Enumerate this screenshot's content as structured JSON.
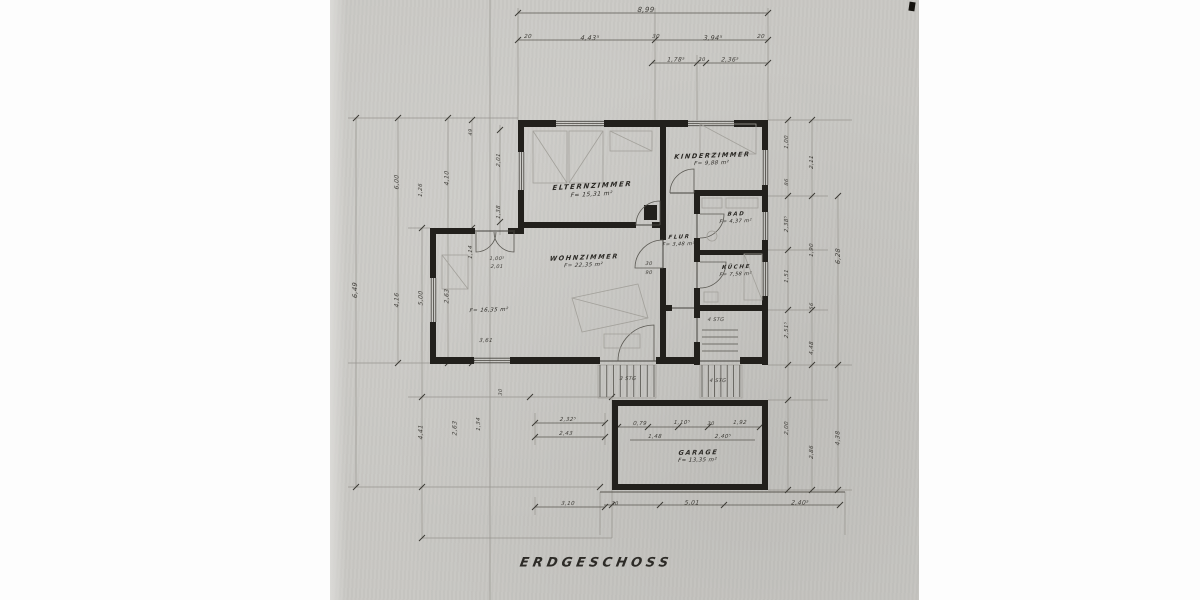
{
  "page": {
    "title": "ERDGESCHOSS"
  },
  "rooms": [
    {
      "id": "elternzimmer",
      "name": "ELTERNZIMMER",
      "area": "F= 15,31 m²",
      "x": 592,
      "y": 190,
      "fs": 7,
      "afs": 6,
      "rot": -3
    },
    {
      "id": "kinderzimmer",
      "name": "KINDERZIMMER",
      "area": "F= 9,88 m²",
      "x": 712,
      "y": 159,
      "fs": 6.5,
      "afs": 5.5,
      "rot": -2
    },
    {
      "id": "bad",
      "name": "BAD",
      "area": "F= 4,37 m²",
      "x": 736,
      "y": 218,
      "fs": 5.5,
      "afs": 5,
      "rot": -2
    },
    {
      "id": "flur",
      "name": "FLUR",
      "area": "F= 3,48 m²",
      "x": 679,
      "y": 241,
      "fs": 5.5,
      "afs": 5,
      "rot": -2
    },
    {
      "id": "kueche",
      "name": "KÜCHE",
      "area": "F= 7,58 m²",
      "x": 736,
      "y": 271,
      "fs": 5.5,
      "afs": 5,
      "rot": -2
    },
    {
      "id": "wohnzimmer",
      "name": "WOHNZIMMER",
      "area": "F= 22,35 m²",
      "x": 584,
      "y": 261,
      "fs": 6.5,
      "afs": 5.5,
      "rot": -2
    },
    {
      "id": "wohnzimmer-erker",
      "name": "",
      "area": "F= 16,35 m²",
      "x": 489,
      "y": 310,
      "fs": 6,
      "afs": 5.5,
      "rot": -2
    },
    {
      "id": "garage",
      "name": "GARAGE",
      "area": "F= 13,35 m²",
      "x": 698,
      "y": 456,
      "fs": 6.5,
      "afs": 5.5,
      "rot": -1
    }
  ],
  "dims": [
    {
      "t": "8,99",
      "x": 646,
      "y": 10,
      "r": 0,
      "fs": 7
    },
    {
      "t": "20",
      "x": 528,
      "y": 37,
      "r": 0,
      "fs": 5.5
    },
    {
      "t": "4,43⁵",
      "x": 590,
      "y": 38,
      "r": 0,
      "fs": 6.5
    },
    {
      "t": "30",
      "x": 656,
      "y": 37,
      "r": 0,
      "fs": 5.5
    },
    {
      "t": "3,94⁵",
      "x": 713,
      "y": 38,
      "r": 0,
      "fs": 6.5
    },
    {
      "t": "20",
      "x": 761,
      "y": 37,
      "r": 0,
      "fs": 5.5
    },
    {
      "t": "1,78⁵",
      "x": 676,
      "y": 60,
      "r": 0,
      "fs": 6
    },
    {
      "t": "30",
      "x": 702,
      "y": 60,
      "r": 0,
      "fs": 5
    },
    {
      "t": "2,36⁵",
      "x": 730,
      "y": 60,
      "r": 0,
      "fs": 6
    },
    {
      "t": "6,49",
      "x": 355,
      "y": 290,
      "r": -90,
      "fs": 6.5
    },
    {
      "t": "6,00",
      "x": 397,
      "y": 182,
      "r": -90,
      "fs": 6
    },
    {
      "t": "4,16",
      "x": 397,
      "y": 300,
      "r": -90,
      "fs": 6
    },
    {
      "t": "1,26",
      "x": 421,
      "y": 190,
      "r": -90,
      "fs": 5.5
    },
    {
      "t": "5,00",
      "x": 421,
      "y": 298,
      "r": -90,
      "fs": 6
    },
    {
      "t": "4,10",
      "x": 447,
      "y": 178,
      "r": -90,
      "fs": 6
    },
    {
      "t": "2,63",
      "x": 447,
      "y": 296,
      "r": -90,
      "fs": 6
    },
    {
      "t": "49",
      "x": 471,
      "y": 132,
      "r": -90,
      "fs": 5
    },
    {
      "t": "1,14",
      "x": 471,
      "y": 252,
      "r": -90,
      "fs": 5.5
    },
    {
      "t": "2,01",
      "x": 499,
      "y": 160,
      "r": -90,
      "fs": 5.5
    },
    {
      "t": "1,38",
      "x": 499,
      "y": 212,
      "r": -90,
      "fs": 5.5
    },
    {
      "t": "1,00⁵",
      "x": 497,
      "y": 259,
      "r": 0,
      "fs": 5
    },
    {
      "t": "2,01",
      "x": 497,
      "y": 267,
      "r": 0,
      "fs": 5
    },
    {
      "t": "30",
      "x": 649,
      "y": 264,
      "r": 0,
      "fs": 5
    },
    {
      "t": "90",
      "x": 649,
      "y": 273,
      "r": 0,
      "fs": 5
    },
    {
      "t": "3,61",
      "x": 486,
      "y": 341,
      "r": 0,
      "fs": 5.5
    },
    {
      "t": "4,41",
      "x": 421,
      "y": 432,
      "r": -90,
      "fs": 6
    },
    {
      "t": "2,63",
      "x": 455,
      "y": 428,
      "r": -90,
      "fs": 6
    },
    {
      "t": "1,34",
      "x": 479,
      "y": 424,
      "r": -90,
      "fs": 5.5
    },
    {
      "t": "30",
      "x": 501,
      "y": 392,
      "r": -90,
      "fs": 5
    },
    {
      "t": "2,32⁵",
      "x": 568,
      "y": 420,
      "r": 0,
      "fs": 5.5
    },
    {
      "t": "2,43",
      "x": 566,
      "y": 434,
      "r": 0,
      "fs": 5.5
    },
    {
      "t": "3,10",
      "x": 568,
      "y": 504,
      "r": 0,
      "fs": 5.5
    },
    {
      "t": "0,79",
      "x": 640,
      "y": 424,
      "r": 0,
      "fs": 5.5
    },
    {
      "t": "1,10⁵",
      "x": 682,
      "y": 423,
      "r": 0,
      "fs": 5.5
    },
    {
      "t": "30",
      "x": 711,
      "y": 424,
      "r": 0,
      "fs": 5
    },
    {
      "t": "1,92",
      "x": 740,
      "y": 423,
      "r": 0,
      "fs": 5.5
    },
    {
      "t": "1,48",
      "x": 655,
      "y": 437,
      "r": 0,
      "fs": 5.5
    },
    {
      "t": "2,40⁵",
      "x": 723,
      "y": 437,
      "r": 0,
      "fs": 5.5
    },
    {
      "t": "30",
      "x": 615,
      "y": 504,
      "r": 0,
      "fs": 5
    },
    {
      "t": "5,01",
      "x": 692,
      "y": 503,
      "r": 0,
      "fs": 6
    },
    {
      "t": "2,40⁵",
      "x": 800,
      "y": 503,
      "r": 0,
      "fs": 6
    },
    {
      "t": "1,00",
      "x": 787,
      "y": 142,
      "r": -90,
      "fs": 5.5
    },
    {
      "t": "86",
      "x": 787,
      "y": 182,
      "r": -90,
      "fs": 5
    },
    {
      "t": "2,38⁵",
      "x": 787,
      "y": 224,
      "r": -90,
      "fs": 5.5
    },
    {
      "t": "1,51",
      "x": 787,
      "y": 276,
      "r": -90,
      "fs": 5.5
    },
    {
      "t": "2,51⁵",
      "x": 787,
      "y": 330,
      "r": -90,
      "fs": 5.5
    },
    {
      "t": "2,00",
      "x": 787,
      "y": 428,
      "r": -90,
      "fs": 5.5
    },
    {
      "t": "2,11",
      "x": 812,
      "y": 162,
      "r": -90,
      "fs": 5.5
    },
    {
      "t": "1,90",
      "x": 812,
      "y": 250,
      "r": -90,
      "fs": 5.5
    },
    {
      "t": "56",
      "x": 812,
      "y": 306,
      "r": -90,
      "fs": 5
    },
    {
      "t": "4,48",
      "x": 812,
      "y": 348,
      "r": -90,
      "fs": 5.5
    },
    {
      "t": "2,86",
      "x": 812,
      "y": 452,
      "r": -90,
      "fs": 5.5
    },
    {
      "t": "6,28",
      "x": 838,
      "y": 256,
      "r": -90,
      "fs": 6.5
    },
    {
      "t": "4,38",
      "x": 838,
      "y": 438,
      "r": -90,
      "fs": 6
    }
  ],
  "notes": [
    {
      "t": "3 STG",
      "x": 628,
      "y": 379,
      "fs": 5
    },
    {
      "t": "4 STG",
      "x": 718,
      "y": 381,
      "fs": 5
    },
    {
      "t": "4 STG",
      "x": 716,
      "y": 320,
      "fs": 5
    }
  ]
}
